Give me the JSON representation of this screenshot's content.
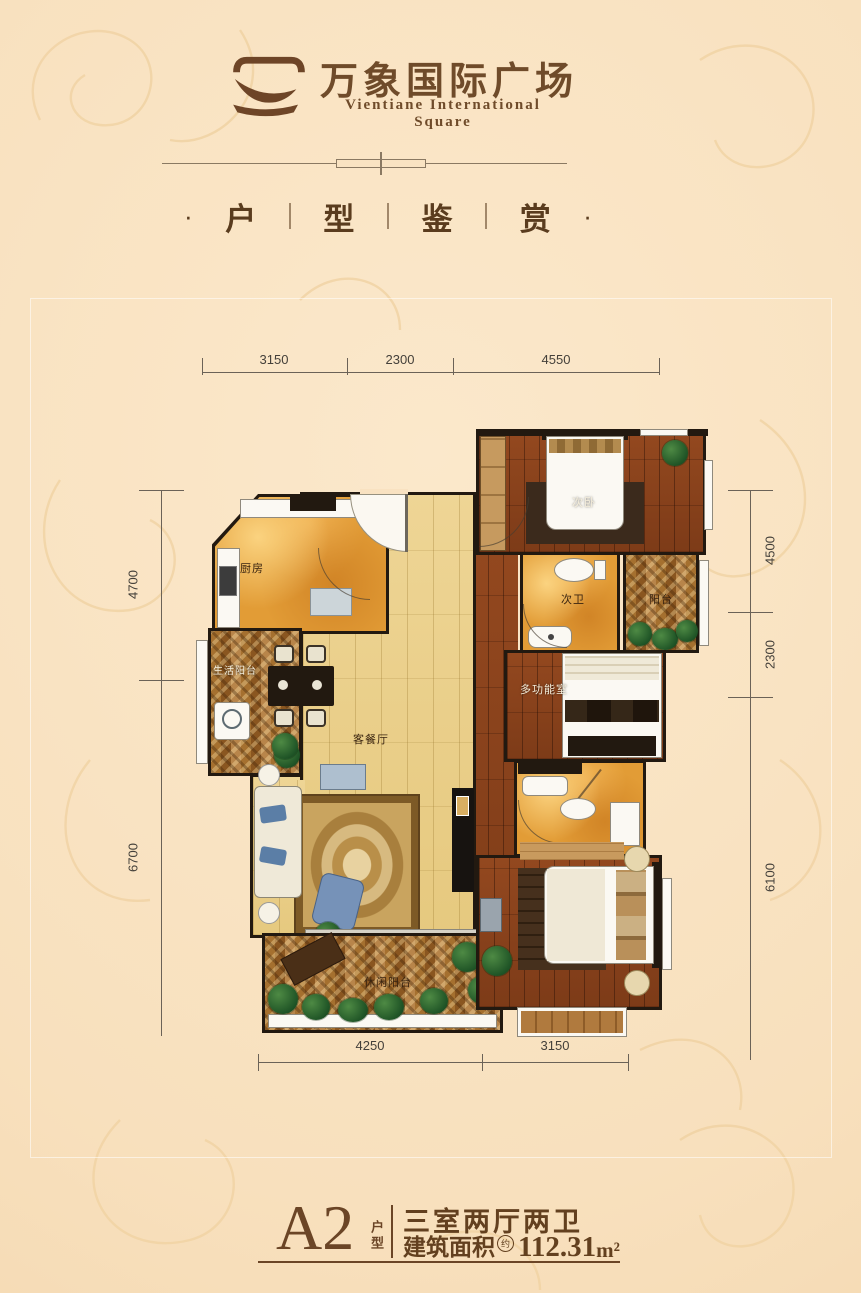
{
  "header": {
    "title_cn": "万象国际广场",
    "title_en": "Vientiane International Square"
  },
  "section_title": {
    "dot": "·",
    "chars": [
      "户",
      "型",
      "鉴",
      "赏"
    ]
  },
  "floorplan": {
    "rooms": {
      "kitchen": "厨房",
      "life_balcony": "生活阳台",
      "living_dining": "客餐厅",
      "leisure_balcony": "休闲阳台",
      "second_bedroom": "次卧",
      "second_bath": "次卫",
      "side_balcony": "阳台",
      "multi_room": "多功能室"
    },
    "dims": {
      "top": [
        "3150",
        "2300",
        "4550"
      ],
      "left": [
        "4700",
        "6700"
      ],
      "right": [
        "4500",
        "2300",
        "6100"
      ],
      "bottom": [
        "4250",
        "3150"
      ]
    }
  },
  "footer": {
    "unit_code": "A2",
    "unit_type_label": "户型",
    "rooms_text": "三室两厅两卫",
    "area_label": "建筑面积",
    "area_note": "约",
    "area_value": "112.31",
    "area_unit": "m²"
  }
}
